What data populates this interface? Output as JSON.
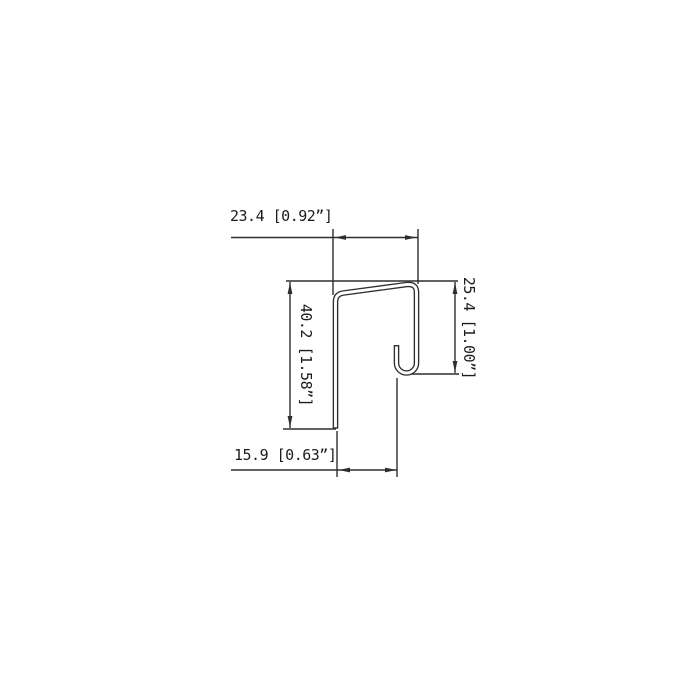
{
  "figure": {
    "kind": "technical-drawing",
    "subject": "sheet-metal-j-profile-cross-section"
  },
  "colors": {
    "background": "#ffffff",
    "line": "#2e2e2e",
    "text": "#1c1c1c"
  },
  "dimensions": {
    "top": {
      "label": "23.4 [0.92”]",
      "mm": "23.4",
      "inch": "0.92”"
    },
    "left": {
      "label": "40.2 [1.58”]",
      "mm": "40.2",
      "inch": "1.58”"
    },
    "right": {
      "label": "25.4 [1.00”]",
      "mm": "25.4",
      "inch": "1.00”"
    },
    "bottom": {
      "label": "15.9 [0.63”]",
      "mm": "15.9",
      "inch": "0.63”"
    }
  }
}
